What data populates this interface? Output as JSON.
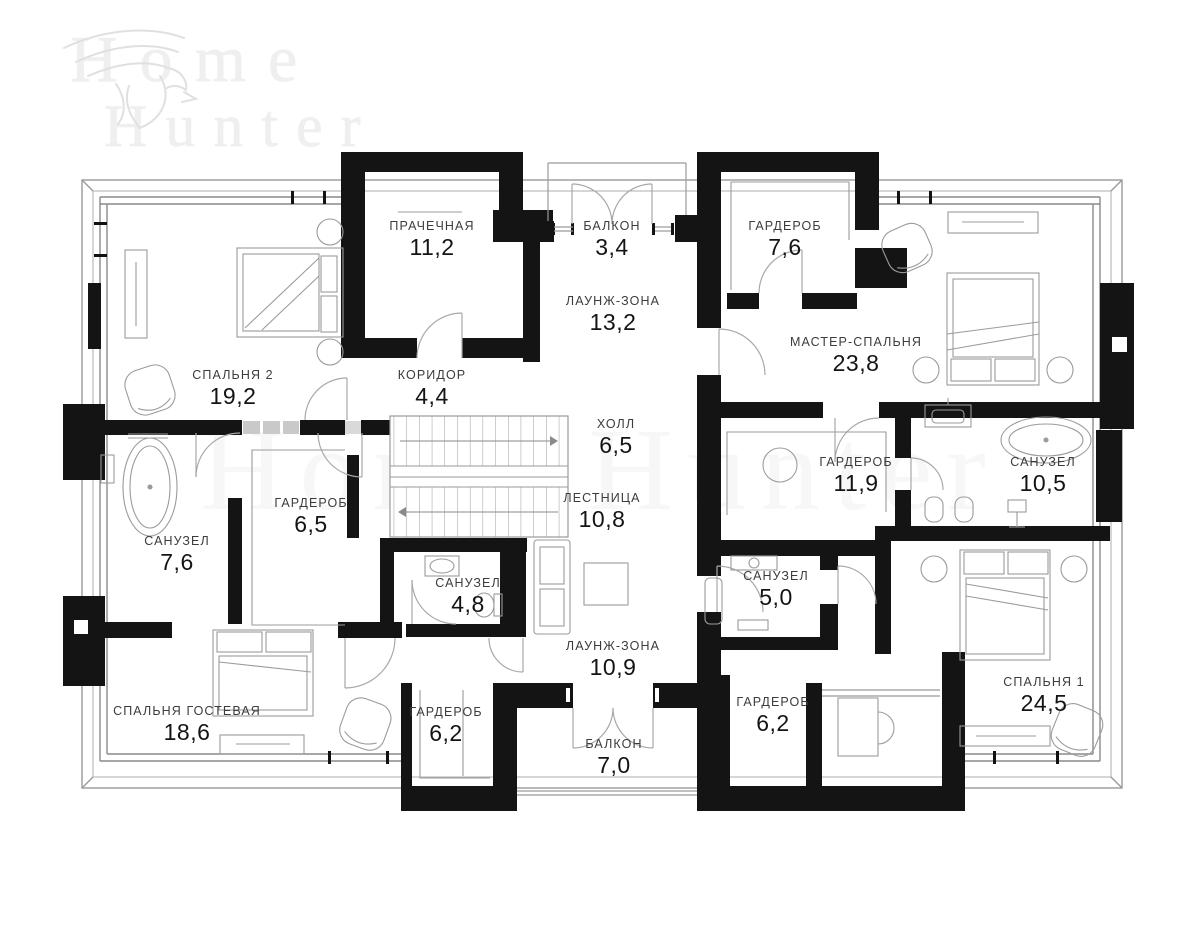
{
  "brand": {
    "word1": "Home",
    "word2": "Hunter",
    "center_watermark": "Home Hunter",
    "eagle_icon": "eagle"
  },
  "plan": {
    "rooms": [
      {
        "name": "ПРАЧЕЧНАЯ",
        "area": "11,2",
        "x": 432,
        "y": 240
      },
      {
        "name": "БАЛКОН",
        "area": "3,4",
        "x": 612,
        "y": 240
      },
      {
        "name": "ГАРДЕРОБ",
        "area": "7,6",
        "x": 785,
        "y": 240
      },
      {
        "name": "ЛАУНЖ-ЗОНА",
        "area": "13,2",
        "x": 613,
        "y": 315
      },
      {
        "name": "МАСТЕР-СПАЛЬНЯ",
        "area": "23,8",
        "x": 856,
        "y": 356
      },
      {
        "name": "СПАЛЬНЯ 2",
        "area": "19,2",
        "x": 233,
        "y": 389
      },
      {
        "name": "КОРИДОР",
        "area": "4,4",
        "x": 432,
        "y": 389
      },
      {
        "name": "ХОЛЛ",
        "area": "6,5",
        "x": 616,
        "y": 438
      },
      {
        "name": "ГАРДЕРОБ",
        "area": "11,9",
        "x": 856,
        "y": 476
      },
      {
        "name": "САНУЗЕЛ",
        "area": "10,5",
        "x": 1043,
        "y": 476
      },
      {
        "name": "ЛЕСТНИЦА",
        "area": "10,8",
        "x": 602,
        "y": 512
      },
      {
        "name": "ГАРДЕРОБ",
        "area": "6,5",
        "x": 311,
        "y": 517
      },
      {
        "name": "САНУЗЕЛ",
        "area": "7,6",
        "x": 177,
        "y": 555
      },
      {
        "name": "САНУЗЕЛ",
        "area": "4,8",
        "x": 468,
        "y": 597
      },
      {
        "name": "САНУЗЕЛ",
        "area": "5,0",
        "x": 776,
        "y": 590
      },
      {
        "name": "ЛАУНЖ-ЗОНА",
        "area": "10,9",
        "x": 613,
        "y": 660
      },
      {
        "name": "СПАЛЬНЯ ГОСТЕВАЯ",
        "area": "18,6",
        "x": 187,
        "y": 725
      },
      {
        "name": "ГАРДЕРОБ",
        "area": "6,2",
        "x": 446,
        "y": 726
      },
      {
        "name": "ГАРДЕРОБ",
        "area": "6,2",
        "x": 773,
        "y": 716
      },
      {
        "name": "БАЛКОН",
        "area": "7,0",
        "x": 614,
        "y": 758
      },
      {
        "name": "СПАЛЬНЯ 1",
        "area": "24,5",
        "x": 1044,
        "y": 696
      }
    ]
  }
}
